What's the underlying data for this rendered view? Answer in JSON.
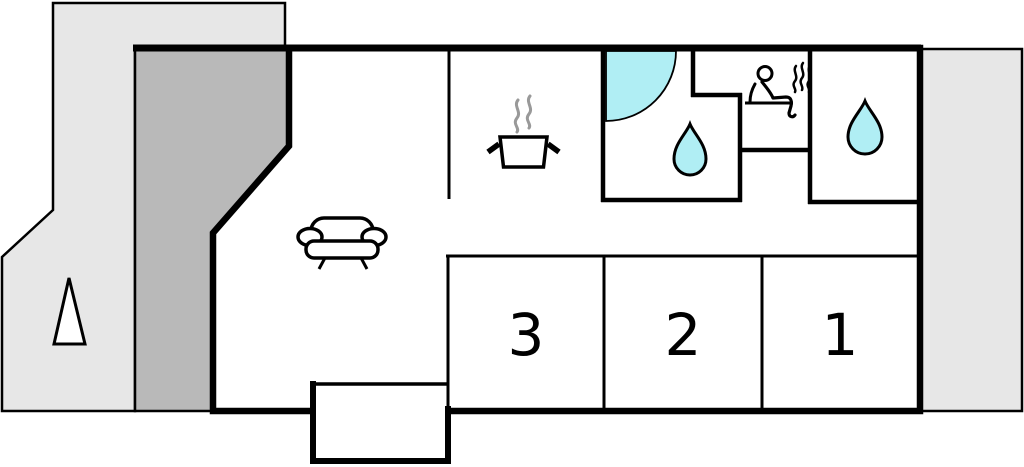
{
  "floorplan": {
    "type": "house-floor-plan",
    "bedrooms": [
      {
        "label": "3"
      },
      {
        "label": "2"
      },
      {
        "label": "1"
      }
    ],
    "areas": {
      "left_terrace": "terrace",
      "carport": "carport",
      "right_terrace": "terrace",
      "living_room": "living-room",
      "kitchen": "kitchen",
      "bathroom": "bathroom",
      "sauna": "sauna",
      "shower_room": "shower-room",
      "entrance": "entrance-vestibule"
    },
    "icons": {
      "tree": "tree-icon",
      "sofa": "sofa-icon",
      "cooking_pot": "cooking-pot-icon",
      "pot_steam": "steam-icon",
      "shower_corner": "shower-quarter-icon",
      "bathroom_drop": "water-drop-icon",
      "sauna_person": "sauna-person-icon",
      "sauna_steam": "steam-icon",
      "shower_room_drop": "water-drop-icon"
    },
    "colors": {
      "terrace": "#e7e7e7",
      "carport": "#b9b9b9",
      "water": "#b0eef4",
      "steam": "#999999",
      "wall": "#000000",
      "floor": "#ffffff"
    }
  }
}
